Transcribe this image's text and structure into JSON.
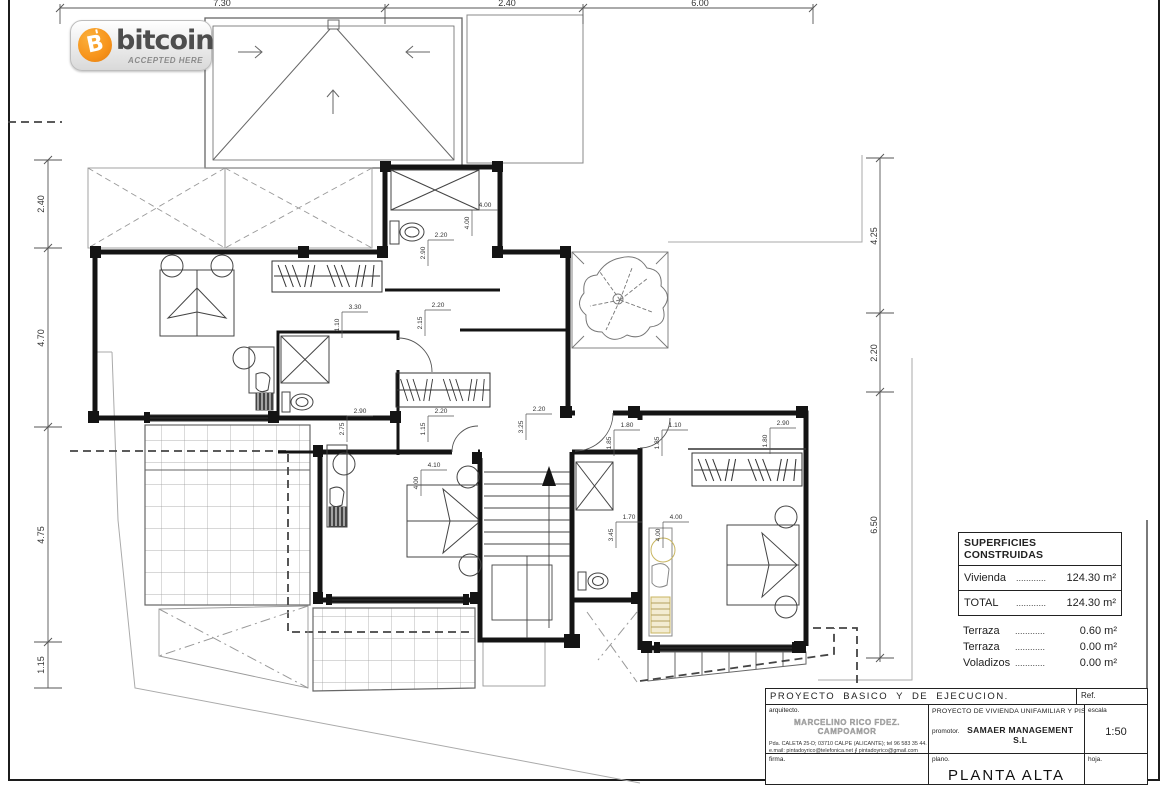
{
  "badge": {
    "brand": "bitcoin",
    "symbol": "B",
    "tagline": "ACCEPTED HERE",
    "coin_color": "#f7931a",
    "text_color": "#4d4d4d"
  },
  "dims": {
    "top": [
      "7.30",
      "2.40",
      "6.00"
    ],
    "left": [
      "2.40",
      "4.70",
      "4.75",
      "1.15"
    ],
    "right": [
      "4.25",
      "2.20",
      "6.50"
    ],
    "interior": [
      "4.00",
      "4.00",
      "3.30",
      "1.10",
      "2.20",
      "2.15",
      "2.20",
      "2.90",
      "2.90",
      "2.75",
      "2.20",
      "1.15",
      "2.20",
      "3.25",
      "1.80",
      "1.85",
      "1.10",
      "1.85",
      "1.70",
      "3.45",
      "4.00",
      "4.00",
      "4.10",
      "4.00",
      "2.90",
      "1.80"
    ]
  },
  "areas_table": {
    "title": "SUPERFICIES CONSTRUIDAS",
    "rows": [
      {
        "label": "Vivienda",
        "dots": "............",
        "value": "124.30 m²"
      }
    ],
    "total": {
      "label": "TOTAL",
      "dots": "............",
      "value": "124.30 m²"
    },
    "extras": [
      {
        "label": "Terraza",
        "dots": "............",
        "value": "0.60 m²"
      },
      {
        "label": "Terraza",
        "dots": "............",
        "value": "0.00 m²"
      },
      {
        "label": "Voladizos",
        "dots": "............",
        "value": "0.00 m²"
      }
    ]
  },
  "title_block": {
    "project_type": "PROYECTO BASICO Y DE EJECUCION.",
    "ref_label": "Ref.",
    "arquitecto_label": "arquitecto.",
    "architect_name": "MARCELINO RICO FDEZ. CAMPOAMOR",
    "address_line1": "Pda. CALETA 25-D; 03710 CALPE (ALICANTE); tel 96 583 35 44.",
    "address_line2": "e.mail: pintadoyrico@telefonica.net   ∮   pintadoyrico@gmail.com",
    "project_title": "PROYECTO DE VIVIENDA UNIFAMILIAR Y PISCINA.",
    "promotor_label": "promotor.",
    "promotor_name": "SAMAER MANAGEMENT S.L",
    "escala_label": "escala",
    "escala_value": "1:50",
    "firma_label": "firma.",
    "plano_label": "plano.",
    "plano_value": "PLANTA ALTA",
    "hoja_label": "hoja."
  }
}
